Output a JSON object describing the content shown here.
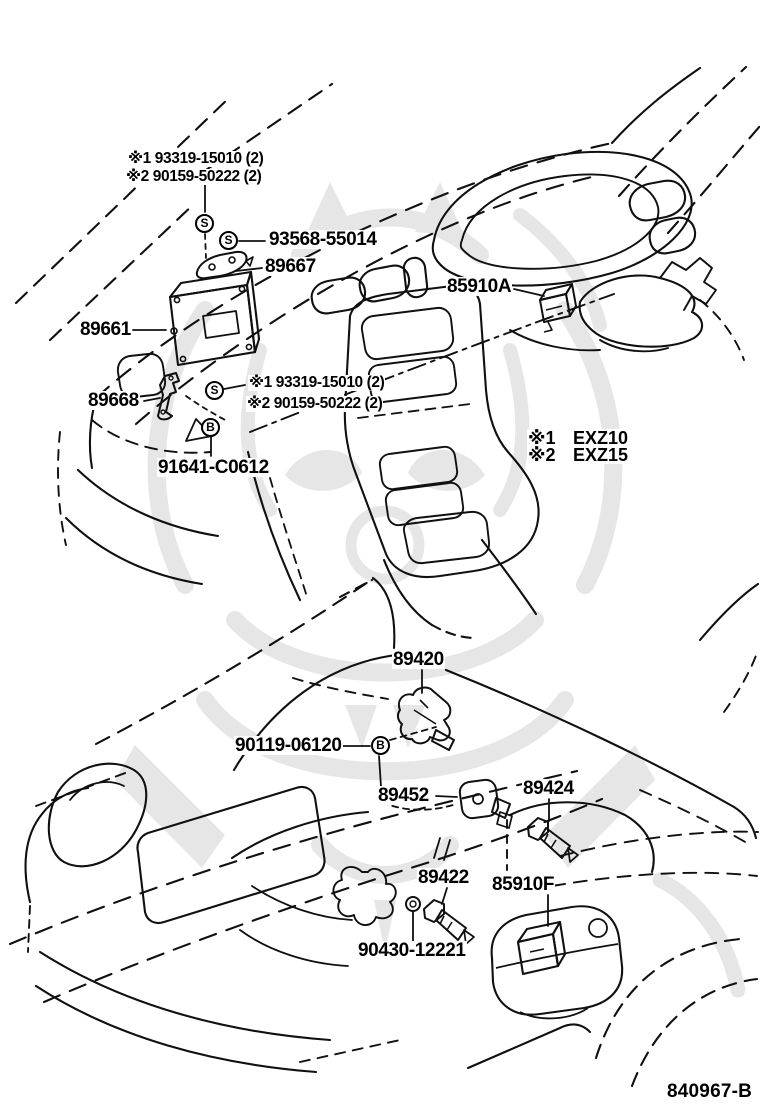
{
  "canvas": {
    "background": "#ffffff",
    "line_color": "#101010",
    "watermark_color": "#e6e6e6"
  },
  "symbols": {
    "screw": "S",
    "bolt": "B"
  },
  "legend": {
    "row1": {
      "mark": "※1",
      "model": "EXZ10"
    },
    "row2": {
      "mark": "※2",
      "model": "EXZ15"
    }
  },
  "notes": {
    "top": {
      "line1": "※1 93319-15010 (2)",
      "line2": "※2 90159-50222 (2)"
    },
    "mid": {
      "line1": "※1 93319-15010 (2)",
      "line2": "※2 90159-50222 (2)"
    }
  },
  "parts": {
    "p93568": "93568-55014",
    "p89667": "89667",
    "p85910A": "85910A",
    "p89661": "89661",
    "p89668": "89668",
    "p91641": "91641-C0612",
    "p89420": "89420",
    "p90119": "90119-06120",
    "p89452": "89452",
    "p89424": "89424",
    "p89422": "89422",
    "p85910F": "85910F",
    "p90430": "90430-12221"
  },
  "footer": {
    "drawing_number": "840967-B"
  }
}
